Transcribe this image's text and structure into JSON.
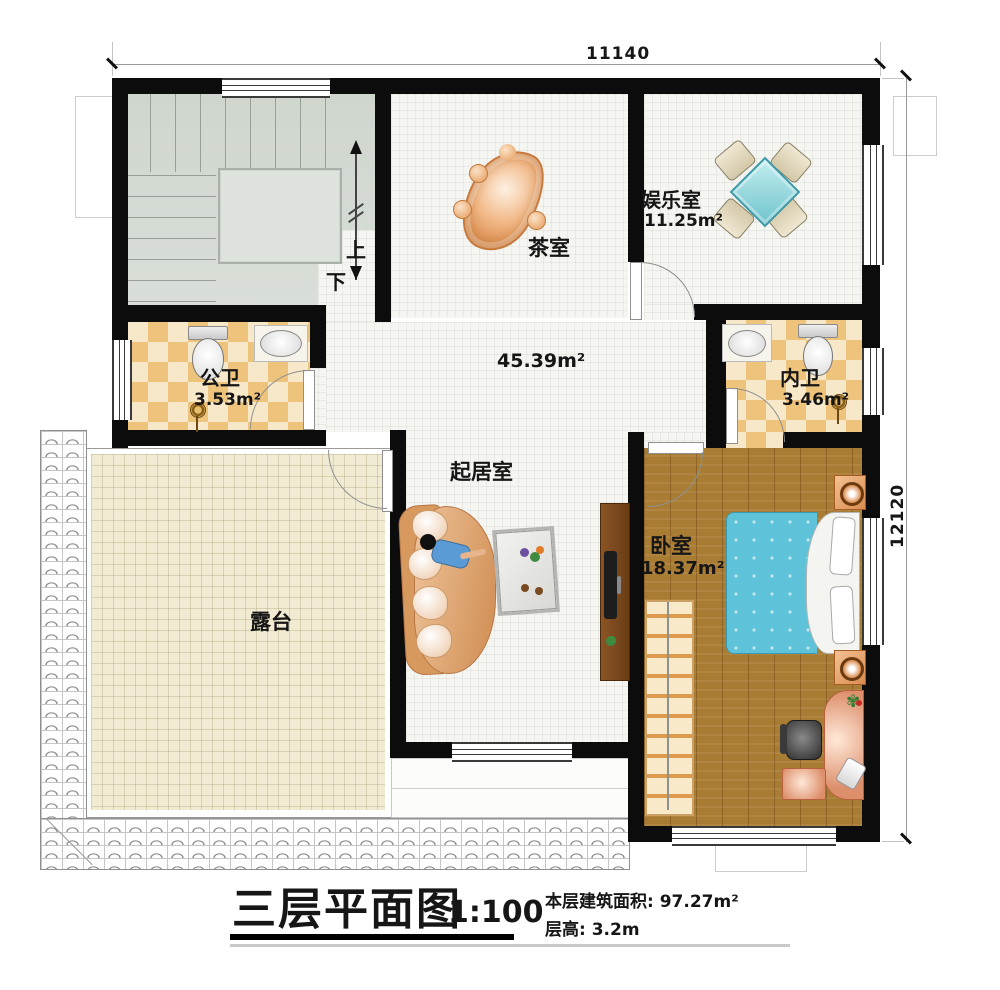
{
  "title_block": {
    "plan_title": "三层平面图",
    "scale": "1:100",
    "area_line": "本层建筑面积: 97.27m²",
    "floor_height_line": "层高: 3.2m"
  },
  "dimensions": {
    "top": "11140",
    "right": "12120"
  },
  "rooms": {
    "stairs": {
      "up": "上",
      "down": "下"
    },
    "tea_room": {
      "name": "茶室"
    },
    "entertainment_room": {
      "name": "娱乐室",
      "area": "11.25m²"
    },
    "public_bathroom": {
      "name": "公卫",
      "area": "3.53m²"
    },
    "private_bathroom": {
      "name": "内卫",
      "area": "3.46m²"
    },
    "living_room": {
      "name": "起居室",
      "area": "45.39m²"
    },
    "bedroom": {
      "name": "卧室",
      "area": "18.37m²"
    },
    "terrace": {
      "name": "露台"
    }
  },
  "colors": {
    "wall": "#0c0c0c",
    "stair_floor": "#d4dbd3",
    "tile_floor": "#f5f5f2",
    "checker_a": "#eec47c",
    "checker_b": "#f6e8c8",
    "wood_floor": "#a97c33",
    "bed": "#5ec3d8",
    "terrace_floor": "#f1ebd3",
    "game_table": "#8fd4d8"
  }
}
